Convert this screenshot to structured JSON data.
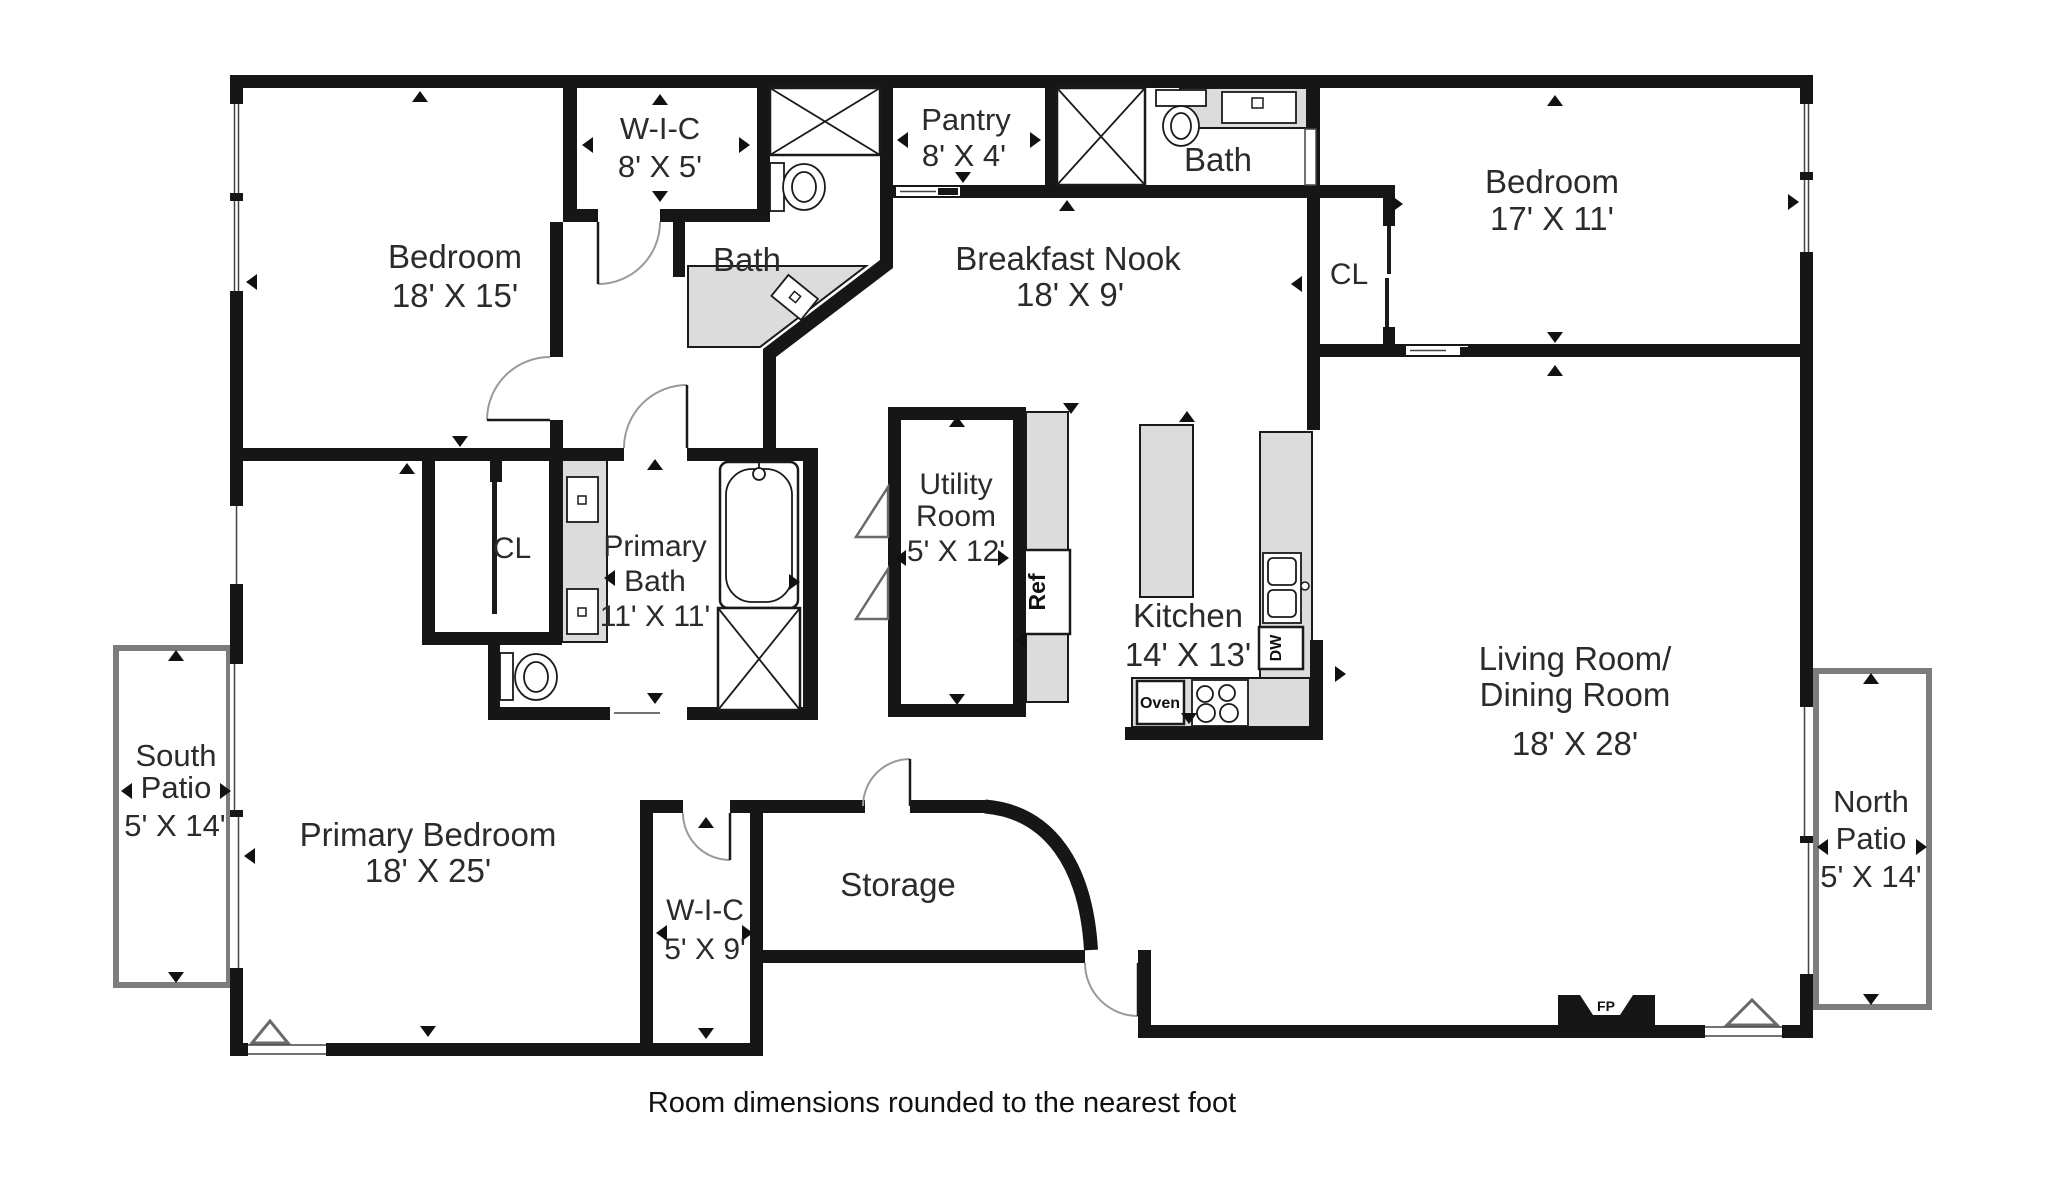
{
  "type": "floor-plan",
  "caption": "Room dimensions rounded to the nearest foot",
  "rooms": {
    "bedroom_tl": {
      "name": "Bedroom",
      "dims": "18' X 15'"
    },
    "wic_top": {
      "name": "W-I-C",
      "dims": "8' X 5'"
    },
    "bath_upper_left": {
      "name": "Bath"
    },
    "pantry": {
      "name": "Pantry",
      "dims": "8' X 4'"
    },
    "bath_upper_mid": {
      "name": "Bath"
    },
    "breakfast_nook": {
      "name": "Breakfast Nook",
      "dims": "18' X 9'"
    },
    "bedroom_tr": {
      "name": "Bedroom",
      "dims": "17' X 11'"
    },
    "closet_tr": {
      "name": "CL"
    },
    "utility_room": {
      "name_line1": "Utility",
      "name_line2": "Room",
      "dims": "5' X 12'"
    },
    "kitchen": {
      "name": "Kitchen",
      "dims": "14' X 13'"
    },
    "living_dining": {
      "name_line1": "Living Room/",
      "name_line2": "Dining Room",
      "dims": "18' X 28'"
    },
    "primary_bath": {
      "name_line1": "Primary",
      "name_line2": "Bath",
      "dims": "11' X 11'"
    },
    "closet_primary": {
      "name": "CL"
    },
    "primary_bedroom": {
      "name": "Primary Bedroom",
      "dims": "18' X 25'"
    },
    "wic_bottom": {
      "name": "W-I-C",
      "dims": "5' X 9'"
    },
    "storage": {
      "name": "Storage"
    },
    "south_patio": {
      "name_line1": "South",
      "name_line2": "Patio",
      "dims": "5' X 14'"
    },
    "north_patio": {
      "name_line1": "North",
      "name_line2": "Patio",
      "dims": "5' X 14'"
    }
  },
  "fixtures": {
    "refrigerator": "Ref",
    "dishwasher": "DW",
    "oven": "Oven",
    "fireplace": "FP"
  },
  "colors": {
    "wall": "#161616",
    "counter": "#dcdcdc",
    "patio_wall": "#7d7d7d",
    "text": "#2b2b2b"
  }
}
